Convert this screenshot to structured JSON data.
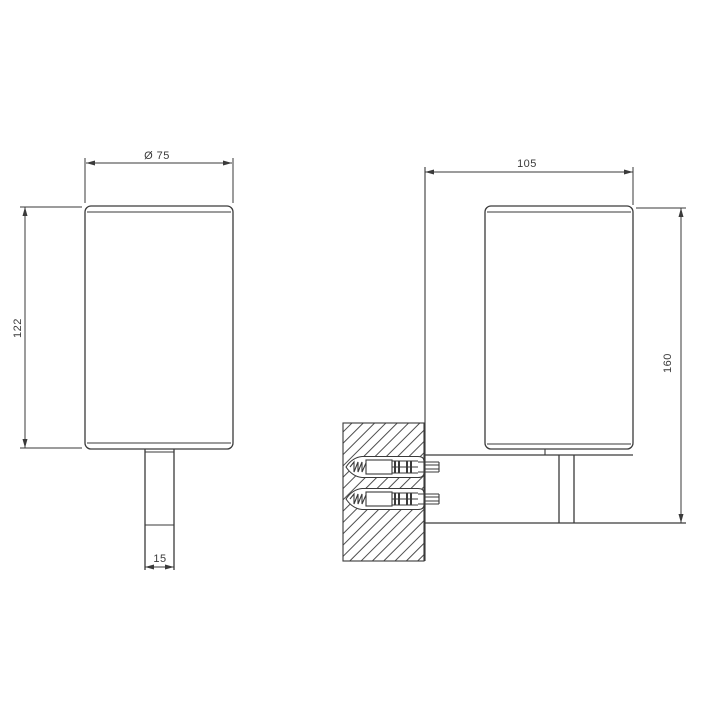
{
  "drawing": {
    "type": "technical dimension drawing, wall-mounted tumbler holder, two orthographic views",
    "colors": {
      "line": "#3a3a3a",
      "text": "#3a3a3a",
      "background": "#ffffff"
    },
    "front_view": {
      "diameter_label": "Ø 75",
      "height_label": "122",
      "stem_width_label": "15"
    },
    "side_view": {
      "depth_label": "105",
      "height_label": "160"
    }
  }
}
